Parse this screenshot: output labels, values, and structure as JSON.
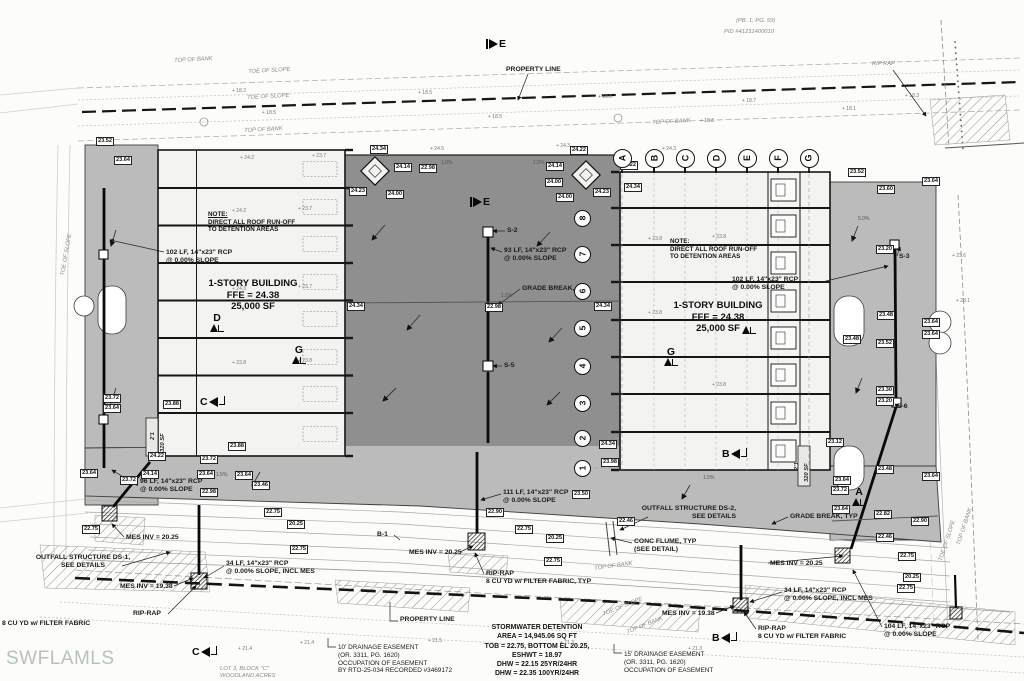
{
  "watermark": "SWFLAMLS",
  "colors": {
    "pavement_light": "#bbbbbb",
    "pavement_dark": "#8f8f8f",
    "building_fill": "#f3f3f1",
    "line_dark": "#161616",
    "gray_text": "#8a8a8a",
    "watermark": "#b6c2bb"
  },
  "buildings": {
    "left": {
      "note": [
        "NOTE:",
        "DIRECT ALL ROOF RUN-OFF",
        "TO DETENTION AREAS"
      ],
      "title": "1-STORY BUILDING",
      "ffe": "FFE = 24.38",
      "area": "25,000 SF"
    },
    "right": {
      "note": [
        "NOTE:",
        "DIRECT ALL ROOF RUN-OFF",
        "TO DETENTION AREAS"
      ],
      "title": "1-STORY BUILDING",
      "ffe": "FFE = 24.38",
      "area": "25,000 SF"
    }
  },
  "detention_note": [
    "STORMWATER DETENTION",
    "AREA = 14,945.06 SQ FT",
    "TOB = 22.75, BOTTOM EL 20.25,",
    "ESHWT = 18.97",
    "DHW = 22.15 25YR/24HR",
    "DHW = 22.35 100YR/24HR"
  ],
  "grid": {
    "columns": {
      "labels": [
        "A",
        "B",
        "C",
        "D",
        "E",
        "F",
        "G"
      ],
      "y": 158,
      "xs": [
        622,
        654,
        685,
        716,
        747,
        778,
        809
      ]
    },
    "rows": {
      "labels": [
        "1",
        "2",
        "3",
        "4",
        "5",
        "6",
        "7",
        "8"
      ],
      "x": 582,
      "ys": [
        468,
        438,
        403,
        366,
        328,
        291,
        254,
        218
      ]
    }
  },
  "section_markers": [
    {
      "l": "E",
      "x": 486,
      "y": 38,
      "d": "right"
    },
    {
      "l": "E",
      "x": 470,
      "y": 196,
      "d": "right"
    },
    {
      "l": "D",
      "x": 210,
      "y": 312,
      "d": "up"
    },
    {
      "l": "G",
      "x": 292,
      "y": 344,
      "d": "up"
    },
    {
      "l": "C",
      "x": 200,
      "y": 396,
      "d": "left"
    },
    {
      "l": "G",
      "x": 664,
      "y": 346,
      "d": "up"
    },
    {
      "l": "",
      "x": 742,
      "y": 326,
      "d": "up"
    },
    {
      "l": "B",
      "x": 722,
      "y": 448,
      "d": "left"
    },
    {
      "l": "A",
      "x": 852,
      "y": 486,
      "d": "up"
    },
    {
      "l": "C",
      "x": 192,
      "y": 646,
      "d": "left"
    },
    {
      "l": "B",
      "x": 712,
      "y": 632,
      "d": "left"
    }
  ],
  "annotations": [
    {
      "t": [
        "PROPERTY LINE"
      ],
      "x": 506,
      "y": 66
    },
    {
      "t": [
        "102 LF, 14\"x23\" RCP",
        "@ 0.00% SLOPE"
      ],
      "x": 166,
      "y": 249
    },
    {
      "t": [
        "93 LF, 14\"x23\" RCP",
        "@ 0.00% SLOPE"
      ],
      "x": 504,
      "y": 247
    },
    {
      "t": [
        "GRADE BREAK, TYP"
      ],
      "x": 522,
      "y": 285
    },
    {
      "t": [
        "S-2"
      ],
      "x": 507,
      "y": 227
    },
    {
      "t": [
        "S-5"
      ],
      "x": 504,
      "y": 362
    },
    {
      "t": [
        "102 LF, 14\"x23\" RCP",
        "@ 0.00% SLOPE"
      ],
      "x": 732,
      "y": 276
    },
    {
      "t": [
        "S-3"
      ],
      "x": 899,
      "y": 253
    },
    {
      "t": [
        "S-6"
      ],
      "x": 897,
      "y": 403
    },
    {
      "t": [
        "GRADE BREAK, TYP"
      ],
      "x": 790,
      "y": 513
    },
    {
      "t": [
        "111 LF, 14\"x23\" RCP",
        "@ 0.00% SLOPE"
      ],
      "x": 503,
      "y": 489
    },
    {
      "t": [
        "OUTFALL STRUCTURE DS-2,",
        "SEE DETAILS"
      ],
      "x": 616,
      "y": 505,
      "wd": 120,
      "align": "right"
    },
    {
      "t": [
        "OUTFALL STRUCTURE DS-1,",
        "SEE DETAILS"
      ],
      "x": 28,
      "y": 554,
      "wd": 110,
      "align": "center"
    },
    {
      "t": [
        "CONC FLUME, TYP",
        "(SEE DETAIL)"
      ],
      "x": 634,
      "y": 538
    },
    {
      "t": [
        "MES INV = 20.25"
      ],
      "x": 126,
      "y": 534
    },
    {
      "t": [
        "MES INV = 20.25"
      ],
      "x": 409,
      "y": 549
    },
    {
      "t": [
        "MES INV = 20.25"
      ],
      "x": 770,
      "y": 560
    },
    {
      "t": [
        "MES INV = 19.38"
      ],
      "x": 120,
      "y": 583
    },
    {
      "t": [
        "MES INV = 19.38"
      ],
      "x": 662,
      "y": 610
    },
    {
      "t": [
        "96 LF, 14\"x23\" RCP",
        "@ 0.00% SLOPE"
      ],
      "x": 140,
      "y": 478
    },
    {
      "t": [
        "34 LF, 14\"x23\" RCP",
        "@ 0.00% SLOPE, INCL MES"
      ],
      "x": 226,
      "y": 560
    },
    {
      "t": [
        "34 LF, 14\"x23\" RCP",
        "@ 0.00% SLOPE, INCL MES"
      ],
      "x": 784,
      "y": 587
    },
    {
      "t": [
        "104 LF, 14\"x23\" RCP",
        "@ 0.00% SLOPE"
      ],
      "x": 884,
      "y": 623
    },
    {
      "t": [
        "RIP-RAP"
      ],
      "x": 133,
      "y": 610
    },
    {
      "t": [
        "8 CU YD w/ FILTER FABRIC"
      ],
      "x": 2,
      "y": 620
    },
    {
      "t": [
        "RIP-RAP",
        "8 CU YD w/ FILTER FABRIC, TYP"
      ],
      "x": 486,
      "y": 570
    },
    {
      "t": [
        "RIP-RAP",
        "8 CU YD w/ FILTER FABRIC"
      ],
      "x": 758,
      "y": 625
    },
    {
      "t": [
        "10' DRAINAGE EASEMENT",
        "(OR. 3311, PG. 1620)",
        "OCCUPATION OF EASEMENT",
        "BY RTO-25-034 RECORDED #3469172"
      ],
      "x": 338,
      "y": 644,
      "w": 400,
      "s": 6.4
    },
    {
      "t": [
        "15' DRAINAGE EASEMENT",
        "(OR. 3311, PG. 1620)",
        "OCCUPATION OF EASEMENT"
      ],
      "x": 624,
      "y": 651,
      "w": 400,
      "s": 6.4
    },
    {
      "t": [
        "PROPERTY LINE"
      ],
      "x": 400,
      "y": 616
    },
    {
      "t": [
        "B-1"
      ],
      "x": 377,
      "y": 531
    }
  ],
  "gray_labels": [
    {
      "t": [
        "(PB. 1, PG. 59)"
      ],
      "x": 736,
      "y": 18
    },
    {
      "t": [
        "PID #41231400010"
      ],
      "x": 724,
      "y": 29
    },
    {
      "t": [
        "RIP RAP"
      ],
      "x": 872,
      "y": 61
    },
    {
      "t": [
        "TOP OF BANK"
      ],
      "x": 174,
      "y": 58,
      "rot": -3
    },
    {
      "t": [
        "TOE OF SLOPE"
      ],
      "x": 248,
      "y": 69,
      "rot": -3
    },
    {
      "t": [
        "TOE OF SLOPE"
      ],
      "x": 247,
      "y": 95,
      "rot": -3
    },
    {
      "t": [
        "TOP OF BANK"
      ],
      "x": 244,
      "y": 128,
      "rot": -3
    },
    {
      "t": [
        "TOP OF BANK"
      ],
      "x": 652,
      "y": 120,
      "rot": -3
    },
    {
      "t": [
        "TOP OF BANK"
      ],
      "x": 594,
      "y": 566,
      "rot": -8
    },
    {
      "t": [
        "TOE OF SLOPE"
      ],
      "x": 602,
      "y": 612,
      "rot": -22
    },
    {
      "t": [
        "TOP OF BANK"
      ],
      "x": 626,
      "y": 630,
      "rot": -22
    },
    {
      "t": [
        "TOE OF SLOPE"
      ],
      "x": 938,
      "y": 560,
      "rot": -72
    },
    {
      "t": [
        "TOP OF BANK"
      ],
      "x": 956,
      "y": 544,
      "rot": -72
    },
    {
      "t": [
        "TOE OF SLOPE"
      ],
      "x": 60,
      "y": 275,
      "rot": -80
    },
    {
      "t": [
        "LOT 3, BLOCK \"C\"",
        "WOODLAND ACRES"
      ],
      "x": 220,
      "y": 666
    },
    {
      "t": [
        "2'1"
      ],
      "x": 150,
      "y": 440,
      "rot": -90,
      "w": 700,
      "c": "#222"
    },
    {
      "t": [
        "320 SF"
      ],
      "x": 160,
      "y": 452,
      "rot": -90,
      "w": 700,
      "c": "#222"
    },
    {
      "t": [
        "2'1"
      ],
      "x": 794,
      "y": 470,
      "rot": -90,
      "w": 700,
      "c": "#222"
    },
    {
      "t": [
        "320 SF"
      ],
      "x": 804,
      "y": 482,
      "rot": -90,
      "w": 700,
      "c": "#222"
    }
  ],
  "elevations": [
    {
      "v": "24.34",
      "x": 370,
      "y": 145
    },
    {
      "v": "24.22",
      "x": 570,
      "y": 146
    },
    {
      "v": "24.22",
      "x": 620,
      "y": 161
    },
    {
      "v": "24.14",
      "x": 394,
      "y": 163
    },
    {
      "v": "22.98",
      "x": 419,
      "y": 164
    },
    {
      "v": "24.23",
      "x": 349,
      "y": 187
    },
    {
      "v": "24.00",
      "x": 386,
      "y": 190
    },
    {
      "v": "24.14",
      "x": 546,
      "y": 162
    },
    {
      "v": "24.00",
      "x": 545,
      "y": 178
    },
    {
      "v": "24.00",
      "x": 556,
      "y": 193
    },
    {
      "v": "24.23",
      "x": 593,
      "y": 188
    },
    {
      "v": "24.34",
      "x": 624,
      "y": 183
    },
    {
      "v": "22.98",
      "x": 485,
      "y": 303
    },
    {
      "v": "24.34",
      "x": 594,
      "y": 302
    },
    {
      "v": "24.34",
      "x": 347,
      "y": 302
    },
    {
      "v": "23.50",
      "x": 572,
      "y": 490
    },
    {
      "v": "22.90",
      "x": 486,
      "y": 508
    },
    {
      "v": "22.75",
      "x": 515,
      "y": 525
    },
    {
      "v": "20.25",
      "x": 546,
      "y": 534
    },
    {
      "v": "22.75",
      "x": 544,
      "y": 557
    },
    {
      "v": "22.46",
      "x": 617,
      "y": 517
    },
    {
      "v": "23.64",
      "x": 80,
      "y": 469
    },
    {
      "v": "23.72",
      "x": 120,
      "y": 476
    },
    {
      "v": "24.14",
      "x": 141,
      "y": 470
    },
    {
      "v": "23.64",
      "x": 197,
      "y": 470
    },
    {
      "v": "23.64",
      "x": 235,
      "y": 471
    },
    {
      "v": "22.98",
      "x": 200,
      "y": 488
    },
    {
      "v": "22.75",
      "x": 82,
      "y": 525
    },
    {
      "v": "22.75",
      "x": 264,
      "y": 508
    },
    {
      "v": "20.25",
      "x": 287,
      "y": 520
    },
    {
      "v": "22.75",
      "x": 290,
      "y": 545
    },
    {
      "v": "23.52",
      "x": 96,
      "y": 137
    },
    {
      "v": "23.64",
      "x": 114,
      "y": 156
    },
    {
      "v": "23.72",
      "x": 103,
      "y": 394
    },
    {
      "v": "23.64",
      "x": 103,
      "y": 404
    },
    {
      "v": "23.52",
      "x": 848,
      "y": 168
    },
    {
      "v": "23.60",
      "x": 877,
      "y": 185
    },
    {
      "v": "23.64",
      "x": 922,
      "y": 177
    },
    {
      "v": "23.20",
      "x": 876,
      "y": 245
    },
    {
      "v": "23.48",
      "x": 877,
      "y": 311
    },
    {
      "v": "23.64",
      "x": 922,
      "y": 318
    },
    {
      "v": "23.64",
      "x": 922,
      "y": 330
    },
    {
      "v": "23.52",
      "x": 876,
      "y": 339
    },
    {
      "v": "23.48",
      "x": 843,
      "y": 335
    },
    {
      "v": "23.30",
      "x": 876,
      "y": 386
    },
    {
      "v": "23.20",
      "x": 876,
      "y": 397
    },
    {
      "v": "23.12",
      "x": 826,
      "y": 438
    },
    {
      "v": "23.48",
      "x": 876,
      "y": 465
    },
    {
      "v": "23.64",
      "x": 922,
      "y": 472
    },
    {
      "v": "23.64",
      "x": 833,
      "y": 476
    },
    {
      "v": "23.72",
      "x": 831,
      "y": 486
    },
    {
      "v": "23.64",
      "x": 832,
      "y": 505
    },
    {
      "v": "22.82",
      "x": 874,
      "y": 510
    },
    {
      "v": "22.90",
      "x": 911,
      "y": 517
    },
    {
      "v": "22.46",
      "x": 876,
      "y": 533
    },
    {
      "v": "22.75",
      "x": 898,
      "y": 552
    },
    {
      "v": "20.25",
      "x": 903,
      "y": 573
    },
    {
      "v": "22.75",
      "x": 897,
      "y": 584
    },
    {
      "v": "23.98",
      "x": 601,
      "y": 458
    },
    {
      "v": "24.34",
      "x": 599,
      "y": 440
    },
    {
      "v": "23.88",
      "x": 163,
      "y": 400
    },
    {
      "v": "23.88",
      "x": 228,
      "y": 442
    },
    {
      "v": "23.46",
      "x": 252,
      "y": 481
    },
    {
      "v": "23.72",
      "x": 200,
      "y": 455
    },
    {
      "v": "24.22",
      "x": 148,
      "y": 452
    }
  ],
  "spot_marks": [
    {
      "v": "24.2",
      "x": 240,
      "y": 155
    },
    {
      "v": "23.7",
      "x": 312,
      "y": 153
    },
    {
      "v": "24.5",
      "x": 430,
      "y": 146
    },
    {
      "v": "24.3",
      "x": 556,
      "y": 143
    },
    {
      "v": "24.3",
      "x": 662,
      "y": 146
    },
    {
      "v": "18.2",
      "x": 232,
      "y": 88
    },
    {
      "v": "18.5",
      "x": 418,
      "y": 90
    },
    {
      "v": "18.6",
      "x": 598,
      "y": 94
    },
    {
      "v": "18.7",
      "x": 742,
      "y": 98
    },
    {
      "v": "18.5",
      "x": 262,
      "y": 110
    },
    {
      "v": "18.5",
      "x": 488,
      "y": 114
    },
    {
      "v": "18.8",
      "x": 700,
      "y": 118
    },
    {
      "v": "24.2",
      "x": 232,
      "y": 208
    },
    {
      "v": "23.7",
      "x": 298,
      "y": 206
    },
    {
      "v": "24.3",
      "x": 232,
      "y": 286
    },
    {
      "v": "23.7",
      "x": 298,
      "y": 284
    },
    {
      "v": "23.8",
      "x": 232,
      "y": 360
    },
    {
      "v": "23.8",
      "x": 298,
      "y": 358
    },
    {
      "v": "23.8",
      "x": 648,
      "y": 236
    },
    {
      "v": "23.8",
      "x": 712,
      "y": 234
    },
    {
      "v": "23.8",
      "x": 648,
      "y": 310
    },
    {
      "v": "23.8",
      "x": 712,
      "y": 382
    },
    {
      "v": "21.4",
      "x": 300,
      "y": 640
    },
    {
      "v": "21.5",
      "x": 428,
      "y": 638
    },
    {
      "v": "21.3",
      "x": 560,
      "y": 640
    },
    {
      "v": "21.3",
      "x": 688,
      "y": 646
    },
    {
      "v": "21.4",
      "x": 238,
      "y": 646
    },
    {
      "v": "18.3",
      "x": 905,
      "y": 93
    },
    {
      "v": "18.1",
      "x": 842,
      "y": 106
    },
    {
      "v": "23.6",
      "x": 952,
      "y": 253
    },
    {
      "v": "23.1",
      "x": 956,
      "y": 298
    }
  ],
  "slope_marks": [
    {
      "v": "1.0%",
      "x": 441,
      "y": 160
    },
    {
      "v": "1.0%",
      "x": 533,
      "y": 160
    },
    {
      "v": "1.5%",
      "x": 501,
      "y": 293
    },
    {
      "v": "1.5%",
      "x": 216,
      "y": 472
    },
    {
      "v": "1.5%",
      "x": 703,
      "y": 475
    },
    {
      "v": "5.0%",
      "x": 858,
      "y": 216
    }
  ]
}
